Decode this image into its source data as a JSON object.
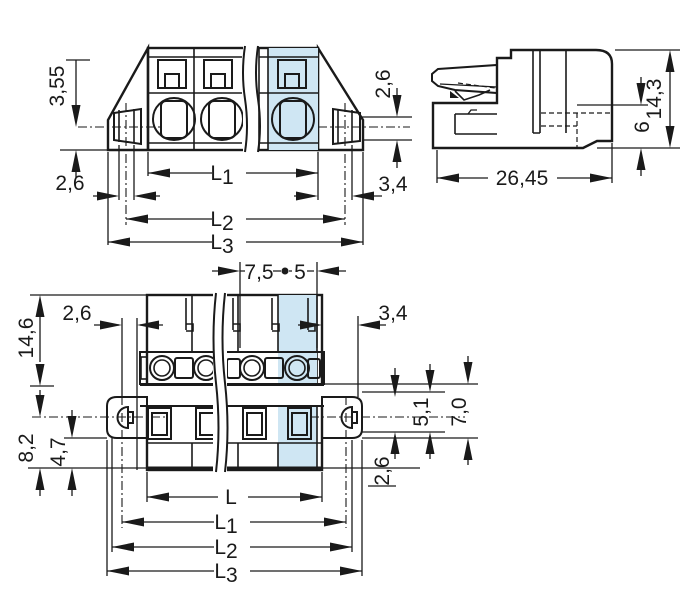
{
  "drawing_type": "connector-dimension-drawing",
  "colors": {
    "body_gray": "#b9bdbf",
    "highlight_blue": "#cfe6f3",
    "lever_yellow": "#f8d303",
    "line_black": "#1a1a1a",
    "background": "#ffffff"
  },
  "front_view": {
    "dim_355": "3,55",
    "dim_26_left": "2,6",
    "dim_26_right": "2,6",
    "dim_34": "3,4",
    "L1": {
      "base": "L",
      "sub": "1"
    },
    "L2": {
      "base": "L",
      "sub": "2"
    },
    "L3": {
      "base": "L",
      "sub": "3"
    }
  },
  "side_view": {
    "dim_143": "14,3",
    "dim_6": "6",
    "dim_2645": "26,45"
  },
  "bottom_view": {
    "dim_75": "7,5",
    "dim_5": "5",
    "dim_26_topleft": "2,6",
    "dim_34": "3,4",
    "dim_146": "14,6",
    "dim_82": "8,2",
    "dim_47": "4,7",
    "dim_51": "5,1",
    "dim_70": "7,0",
    "dim_26_bottomright": "2,6",
    "L": "L",
    "L1": {
      "base": "L",
      "sub": "1"
    },
    "L2": {
      "base": "L",
      "sub": "2"
    },
    "L3": {
      "base": "L",
      "sub": "3"
    }
  }
}
